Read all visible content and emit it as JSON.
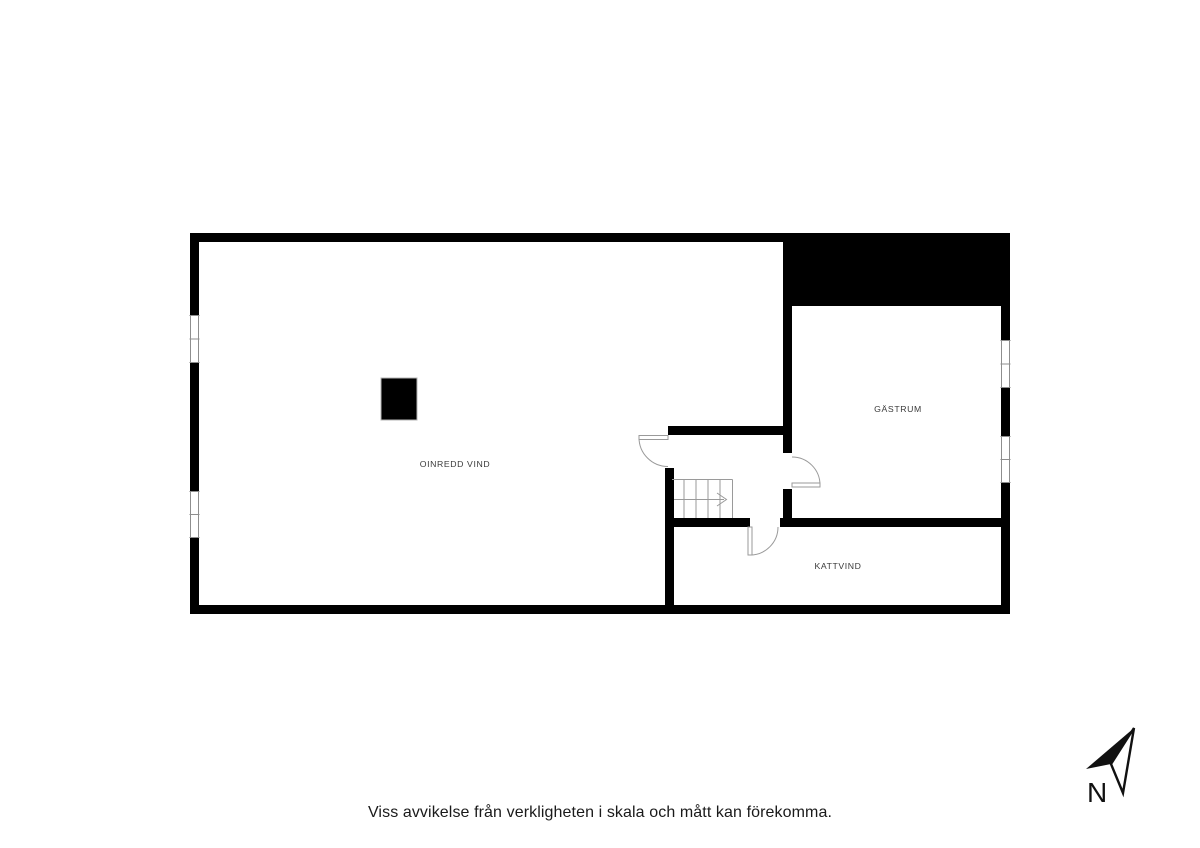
{
  "page": {
    "background_color": "#ffffff",
    "disclaimer": "Viss avvikelse från verkligheten i skala och mått kan förekomma."
  },
  "floor_plan": {
    "colors": {
      "wall": "#000000",
      "thin_line": "#9a9a9a",
      "room_label": "#3a3a3a",
      "disclaimer_text": "#1a1a1a"
    },
    "rooms": [
      {
        "key": "oinredd-vind",
        "label": "OINREDD VIND"
      },
      {
        "key": "gastrum",
        "label": "GÄSTRUM"
      },
      {
        "key": "kattvind",
        "label": "KATTVIND"
      }
    ]
  },
  "compass": {
    "icon": "north-arrow-icon",
    "label": "N"
  }
}
